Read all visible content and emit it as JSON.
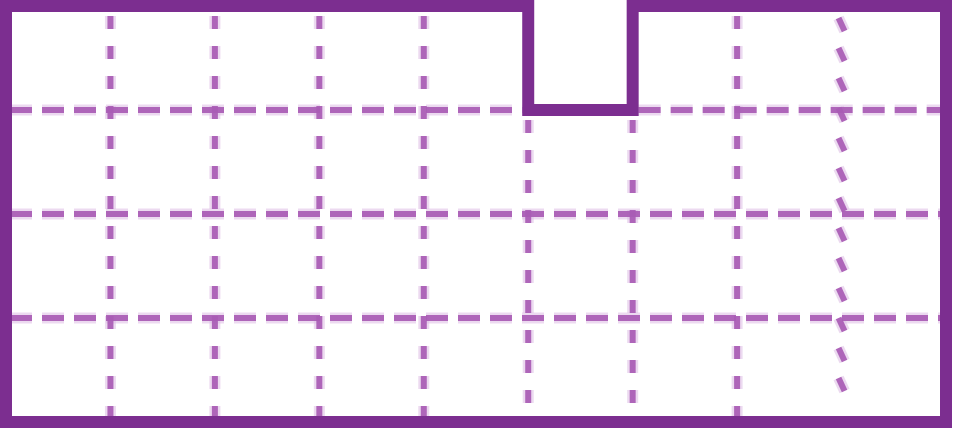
{
  "figure": {
    "description": "A rectilinear shape drawn on a dashed unit-square grid: a 9-by-4 rectangle of unit squares with one unit square notched out of the top edge at the sixth column",
    "grid": {
      "columns": 9,
      "rows": 4,
      "notch": {
        "column_index": 5,
        "row_index": 0,
        "width_units": 1,
        "height_units": 1
      }
    },
    "visible_unit_squares": 35,
    "colors": {
      "outline": "#7c2e90",
      "dash_core": "#a85bb4",
      "dash_halo": "#ddbbe3",
      "background": "#ffffff"
    },
    "outline_stroke_width": 12,
    "dash_core_width": 6,
    "dash_halo_width": 11,
    "dash_pattern_horizontal": "22 10",
    "dash_pattern_vertical": "13 17"
  }
}
